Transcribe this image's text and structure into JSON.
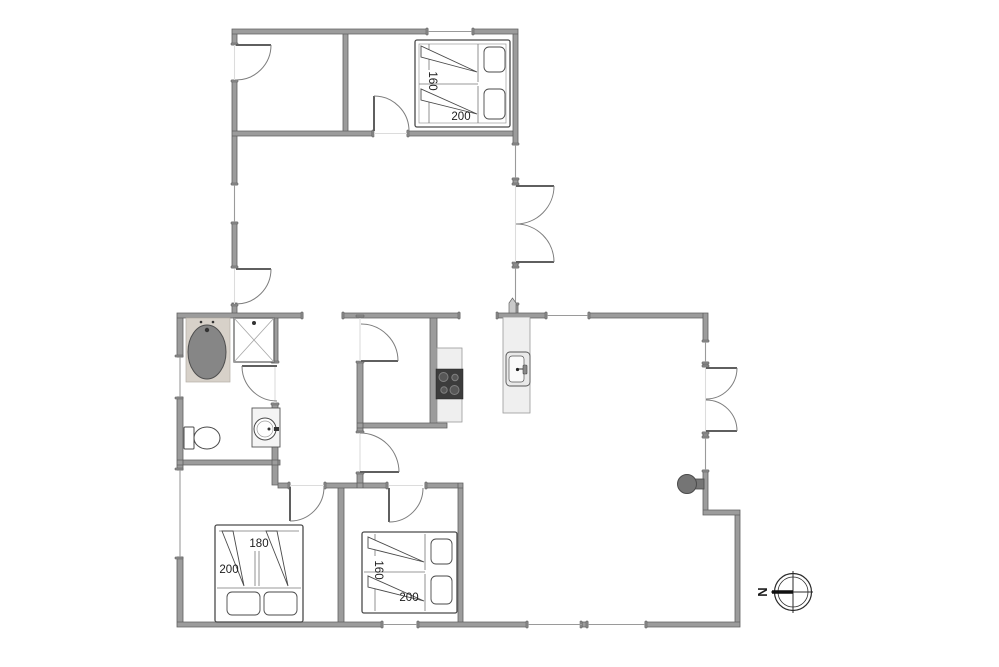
{
  "page": {
    "background": "#ffffff",
    "type": "floor-plan"
  },
  "labels": {
    "bed_top": {
      "width": "160",
      "length": "200"
    },
    "bed_left": {
      "width": "180",
      "length": "200"
    },
    "bed_middle": {
      "width": "160",
      "length": "200"
    },
    "compass": {
      "north": "N"
    }
  },
  "colors": {
    "wall": "#9c9c9c",
    "wall_cap": "#8f8f8f",
    "window_line": "#9a9a9a",
    "door_line": "#7d7d7d",
    "bathtub_fill": "#868686",
    "bathtub_platform": "#d7d1c9",
    "counter_fill": "#efefef",
    "cooktop_fill": "#3c3c3c",
    "stove_fill": "#757575"
  }
}
